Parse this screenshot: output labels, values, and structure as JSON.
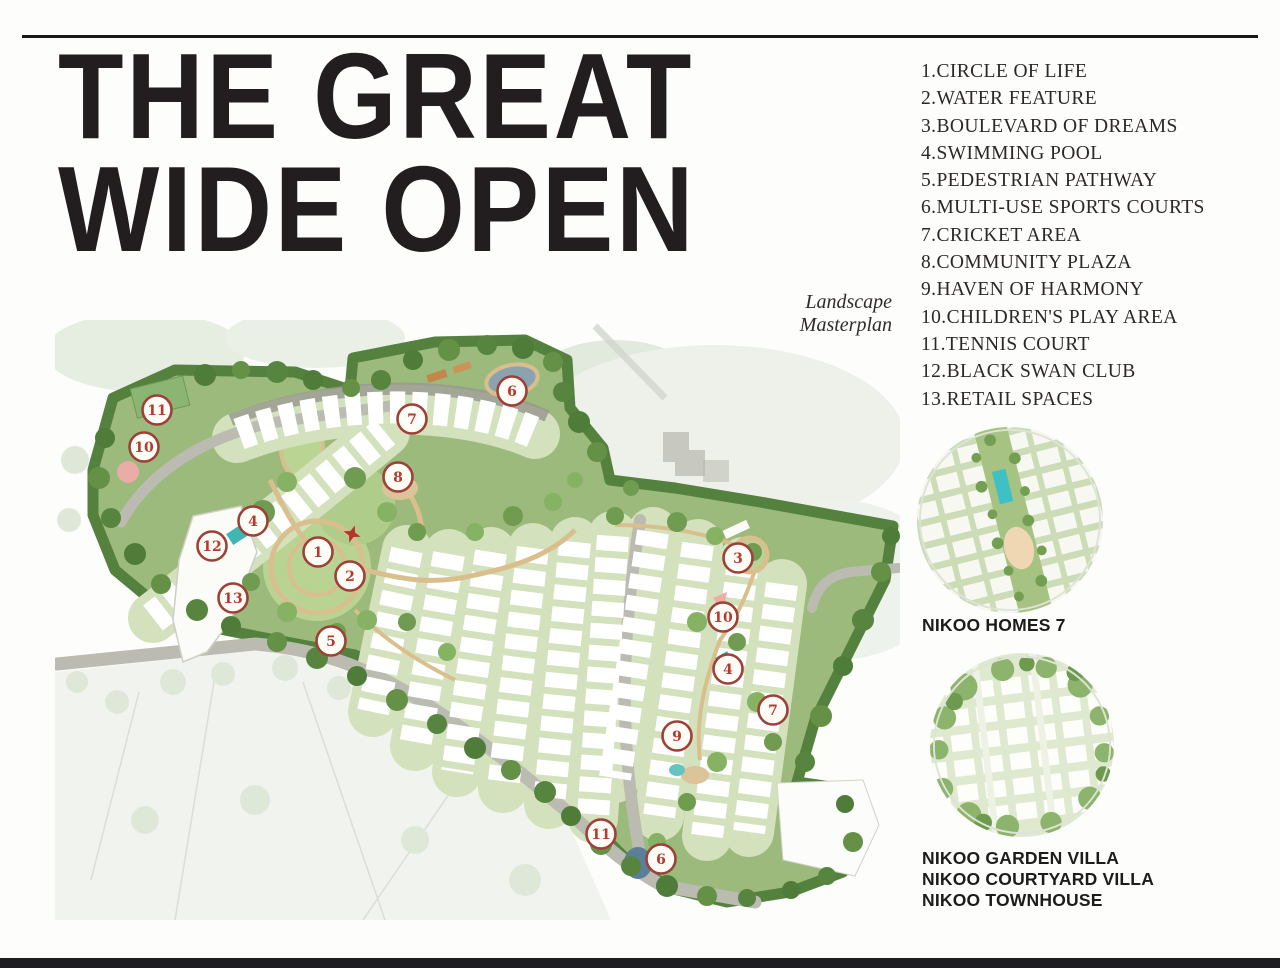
{
  "header": {
    "title_line1": "THE GREAT",
    "title_line2": "WIDE OPEN",
    "subtitle": "Landscape Masterplan"
  },
  "legend": {
    "items": [
      {
        "num": "1.",
        "label": "CIRCLE OF LIFE"
      },
      {
        "num": "2.",
        "label": "WATER FEATURE"
      },
      {
        "num": "3.",
        "label": "BOULEVARD OF DREAMS"
      },
      {
        "num": "4.",
        "label": "SWIMMING POOL"
      },
      {
        "num": "5.",
        "label": "PEDESTRIAN PATHWAY"
      },
      {
        "num": "6.",
        "label": "MULTI-USE SPORTS COURTS"
      },
      {
        "num": "7.",
        "label": "CRICKET AREA"
      },
      {
        "num": "8.",
        "label": "COMMUNITY PLAZA"
      },
      {
        "num": "9.",
        "label": "HAVEN OF HARMONY"
      },
      {
        "num": "10.",
        "label": "CHILDREN'S PLAY AREA"
      },
      {
        "num": "11.",
        "label": "TENNIS COURT"
      },
      {
        "num": "12.",
        "label": "BLACK SWAN CLUB"
      },
      {
        "num": "13.",
        "label": "RETAIL SPACES"
      }
    ]
  },
  "map_markers": [
    {
      "n": "11",
      "x": 102,
      "y": 90
    },
    {
      "n": "10",
      "x": 89,
      "y": 127
    },
    {
      "n": "7",
      "x": 357,
      "y": 99
    },
    {
      "n": "8",
      "x": 343,
      "y": 157
    },
    {
      "n": "6",
      "x": 457,
      "y": 71
    },
    {
      "n": "4",
      "x": 198,
      "y": 201
    },
    {
      "n": "12",
      "x": 157,
      "y": 226
    },
    {
      "n": "1",
      "x": 263,
      "y": 232
    },
    {
      "n": "2",
      "x": 295,
      "y": 256
    },
    {
      "n": "13",
      "x": 178,
      "y": 278
    },
    {
      "n": "5",
      "x": 276,
      "y": 321
    },
    {
      "n": "3",
      "x": 683,
      "y": 238
    },
    {
      "n": "10",
      "x": 668,
      "y": 297
    },
    {
      "n": "4",
      "x": 673,
      "y": 349
    },
    {
      "n": "7",
      "x": 718,
      "y": 390
    },
    {
      "n": "9",
      "x": 622,
      "y": 416
    },
    {
      "n": "11",
      "x": 546,
      "y": 514
    },
    {
      "n": "6",
      "x": 606,
      "y": 539
    }
  ],
  "insets": {
    "homes_label": "NIKOO HOMES 7",
    "villa_labels": [
      "NIKOO GARDEN VILLA",
      "NIKOO COURTYARD VILLA",
      "NIKOO TOWNHOUSE"
    ]
  },
  "colors": {
    "marker_ring": "#9c4038",
    "marker_number": "#b23a31",
    "title_black": "#221e20",
    "site_green": "#9cba7b",
    "rule_black": "#181818"
  }
}
